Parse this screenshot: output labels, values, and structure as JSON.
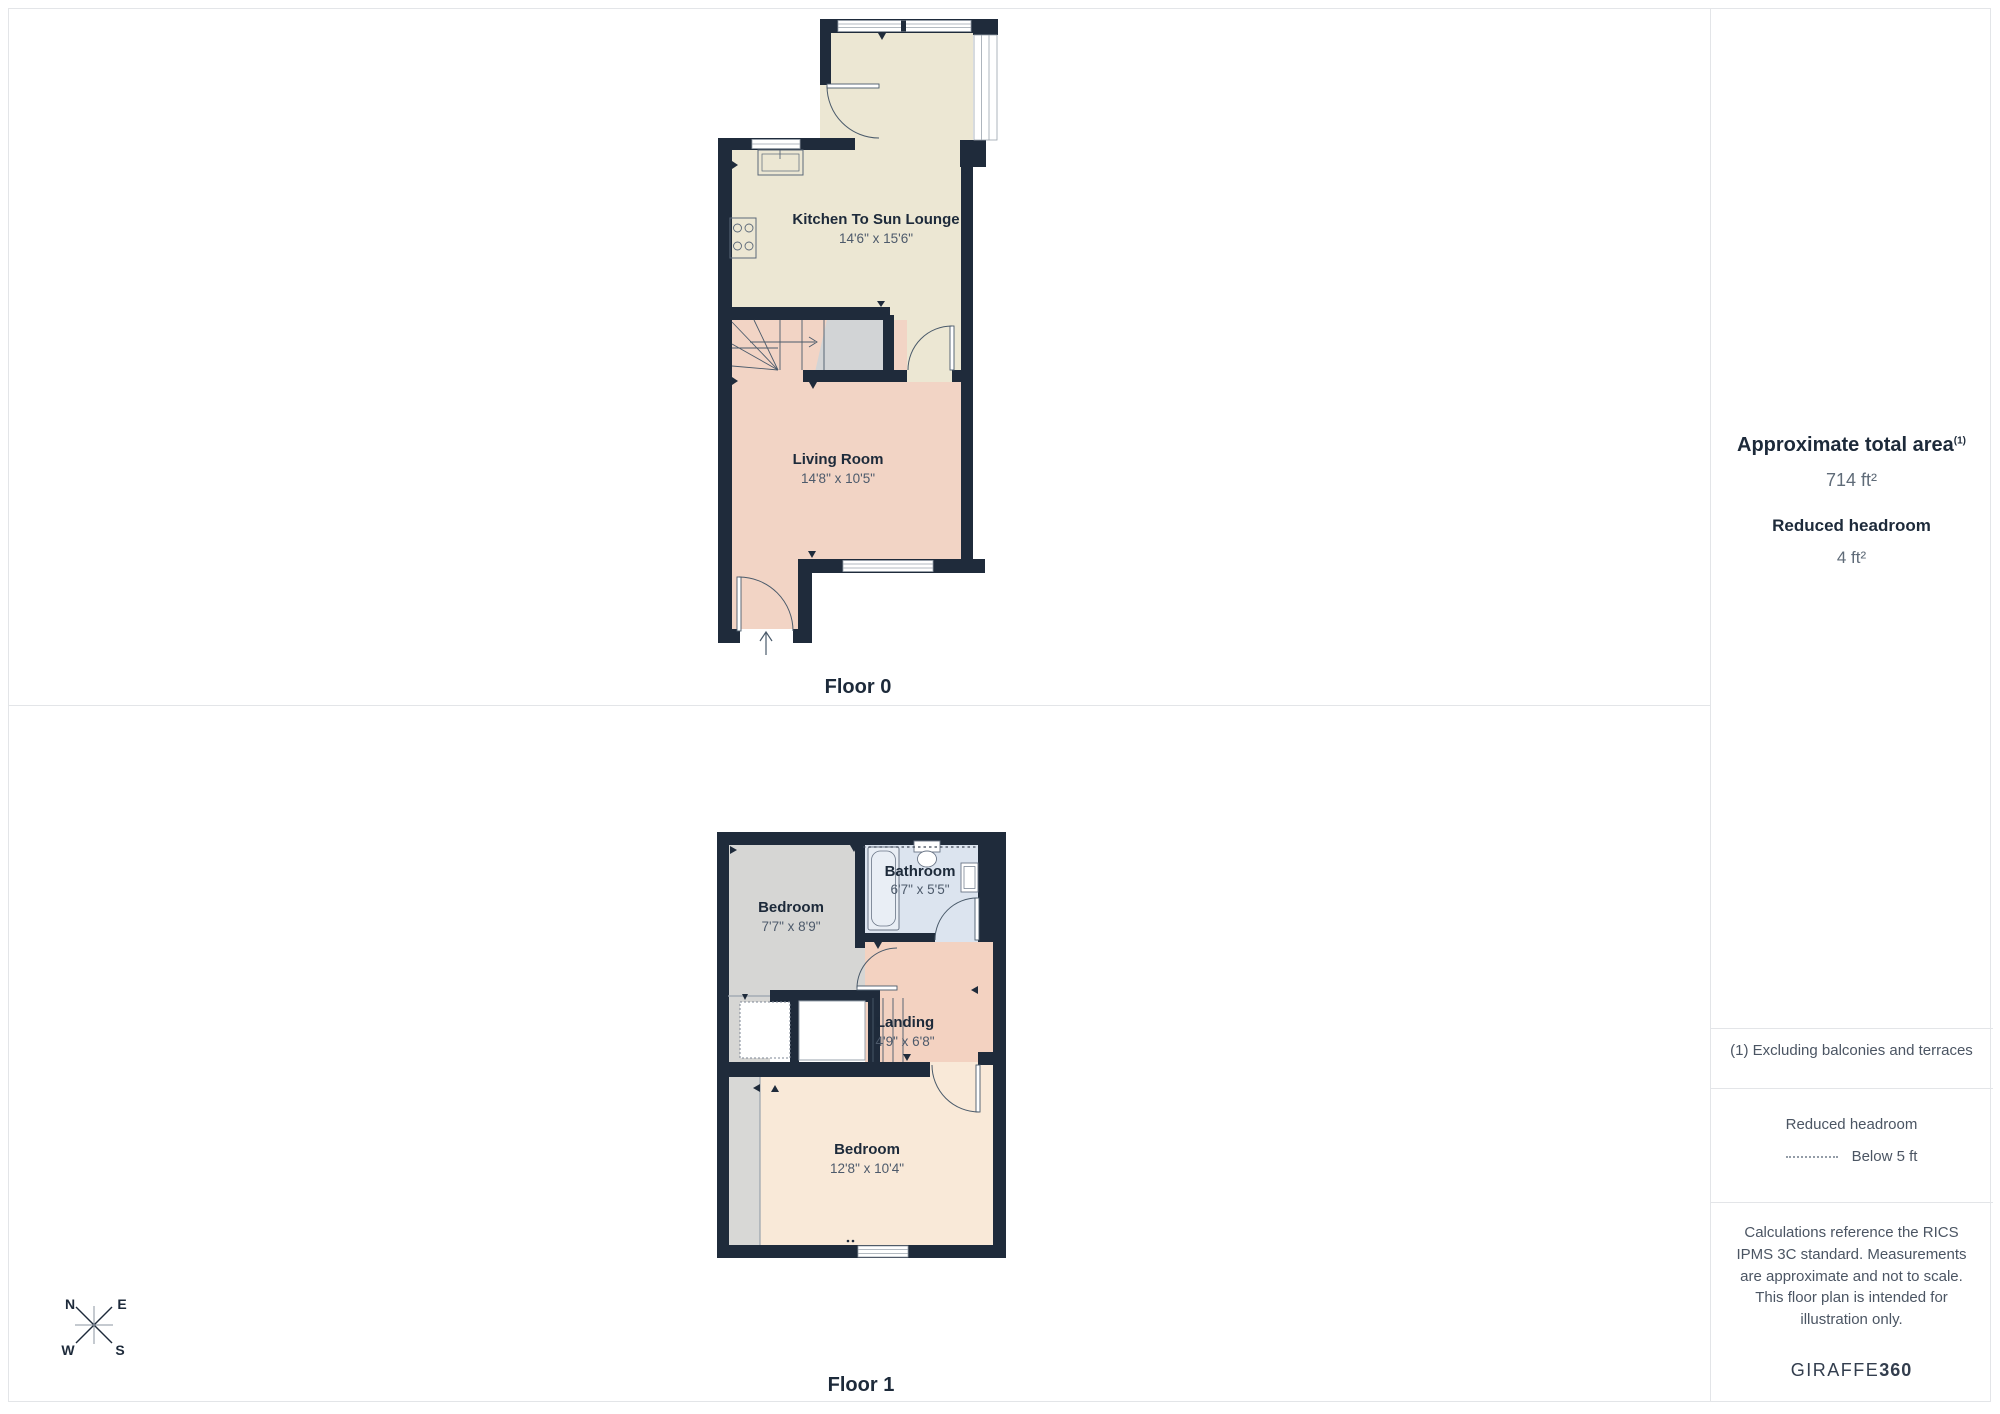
{
  "floors": {
    "floor0": {
      "label": "Floor 0",
      "rooms": [
        {
          "name": "Kitchen To Sun Lounge",
          "dims": "14'6\" x 15'6\""
        },
        {
          "name": "Living Room",
          "dims": "14'8\" x 10'5\""
        }
      ]
    },
    "floor1": {
      "label": "Floor 1",
      "rooms": [
        {
          "name": "Bedroom",
          "dims": "7'7\" x 8'9\""
        },
        {
          "name": "Bathroom",
          "dims": "6'7\" x 5'5\""
        },
        {
          "name": "Landing",
          "dims": "4'9\" x 6'8\""
        },
        {
          "name": "Bedroom",
          "dims": "12'8\" x 10'4\""
        }
      ]
    }
  },
  "sidebar": {
    "total_area_label": "Approximate total area",
    "total_area_footnote_marker": "(1)",
    "total_area_value": "714 ft²",
    "reduced_headroom_label": "Reduced headroom",
    "reduced_headroom_value": "4 ft²",
    "footnote": "(1) Excluding balconies and terraces",
    "legend_title": "Reduced headroom",
    "legend_item": "Below 5 ft",
    "disclaimer": "Calculations reference the RICS IPMS 3C standard. Measurements are approximate and not to scale. This floor plan is intended for illustration only.",
    "brand_regular": "GIRAFFE",
    "brand_bold": "360"
  },
  "compass": {
    "n": "N",
    "e": "E",
    "w": "W",
    "s": "S"
  },
  "colors": {
    "wall": "#1f2b3b",
    "kitchen_floor": "#ece7d3",
    "living_floor": "#f2d4c5",
    "bedroom1_floor": "#d6d6d4",
    "bathroom_floor": "#dce4ef",
    "landing_floor": "#f3d2c1",
    "bedroom2_floor": "#f9e9d8",
    "reduced_headroom_gray": "#d2d4d6",
    "text_primary": "#1d2a3a",
    "text_secondary": "#4d5a6b",
    "divider": "#e3e5e8"
  }
}
